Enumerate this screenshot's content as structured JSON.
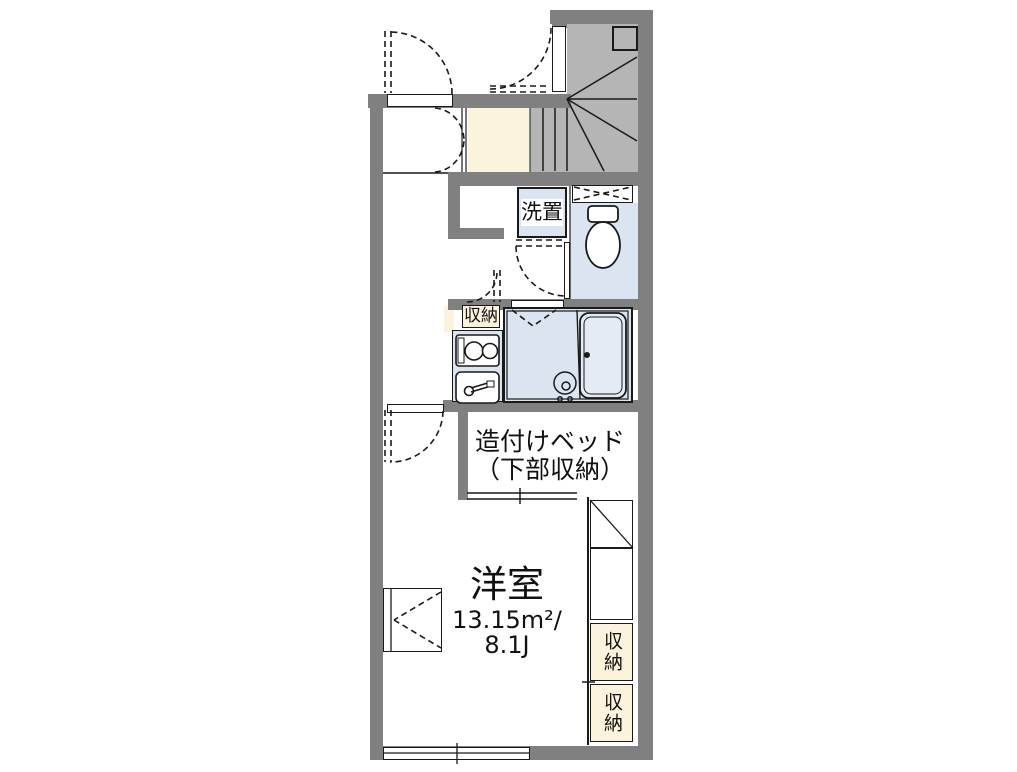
{
  "floorplan": {
    "rooms": {
      "washer": {
        "label": "洗置"
      },
      "kitchen_storage": {
        "label": "収納"
      },
      "built_in_bed": {
        "line1": "造付けベッド",
        "line2": "（下部収納）"
      },
      "western_room": {
        "name": "洋室",
        "area_sqm": "13.15m²/",
        "area_jo": "8.1J"
      },
      "closet_upper": {
        "label": "収納"
      },
      "closet_lower": {
        "label": "収納"
      }
    },
    "colors": {
      "wall": "#808080",
      "stair_fill": "#b5b5b5",
      "water_area_fill": "#dbe5f1",
      "storage_fill": "#fcf3dd",
      "line": "#1a1a1a"
    }
  }
}
